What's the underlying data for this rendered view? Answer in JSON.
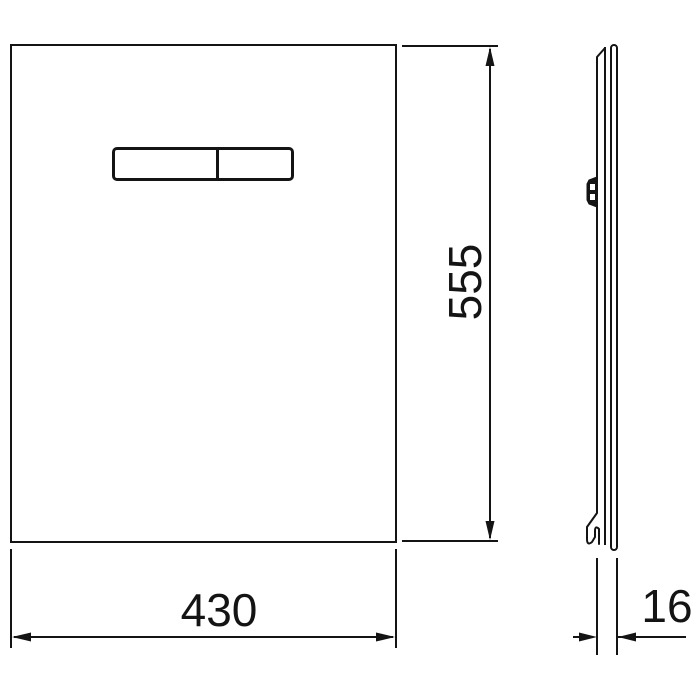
{
  "drawing": {
    "type": "technical-dimension-drawing",
    "colors": {
      "line": "#141414",
      "background": "#ffffff"
    },
    "front_view": {
      "name": "flush plate front view",
      "button": "dual flush actuator"
    },
    "side_view": {
      "name": "flush plate side profile",
      "details": [
        "mounting-clip",
        "bottom-hook"
      ]
    },
    "dimensions": {
      "width": {
        "value": "430",
        "orientation": "horizontal"
      },
      "height": {
        "value": "555",
        "orientation": "vertical"
      },
      "depth": {
        "value": "16",
        "orientation": "horizontal"
      }
    }
  }
}
